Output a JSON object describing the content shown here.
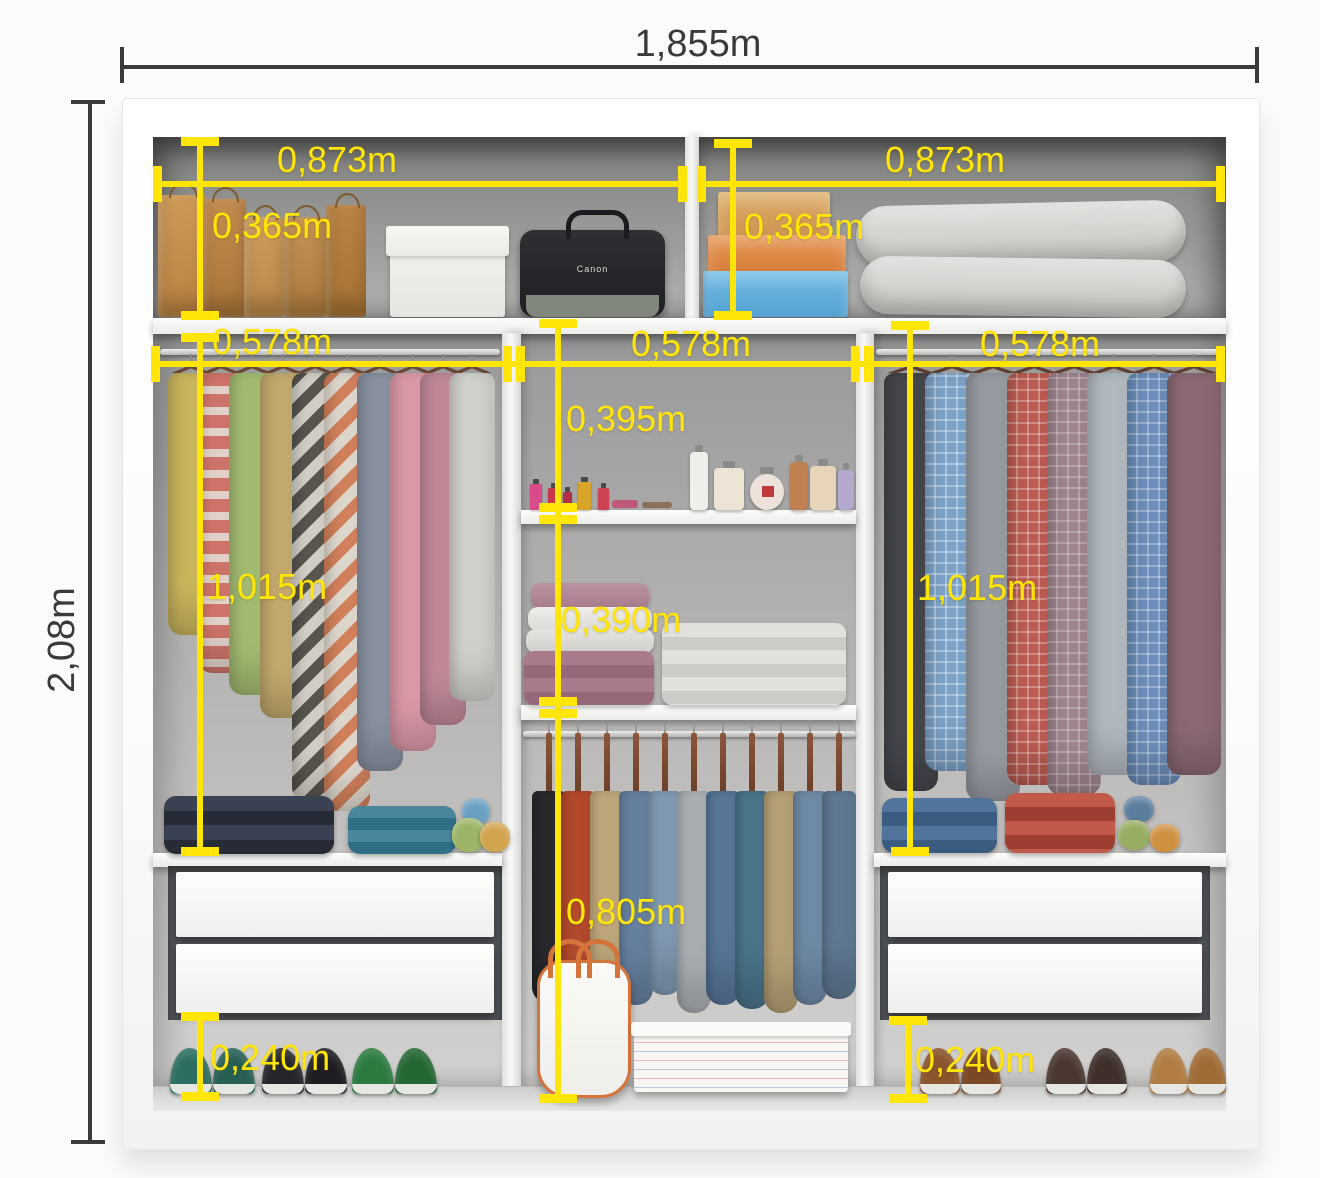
{
  "dimensions": {
    "overall_width": "1,855m",
    "overall_height": "2,08m",
    "top_shelf_left_width": "0,873m",
    "top_shelf_right_width": "0,873m",
    "top_shelf_left_height": "0,365m",
    "top_shelf_right_height": "0,365m",
    "left_column_width": "0,578m",
    "middle_column_width": "0,578m",
    "right_column_width": "0,578m",
    "middle_upper_section_height": "0,395m",
    "middle_towel_section_height": "0,390m",
    "left_hanging_height": "1,015m",
    "right_hanging_height": "1,015m",
    "middle_hanging_height": "0,805m",
    "left_shoe_area_height": "0,240m",
    "right_shoe_area_height": "0,240m"
  },
  "items": {
    "camera_bag_brand": "Canon"
  },
  "colors": {
    "dimension_yellow": "#ffe608",
    "dimension_black": "#3a3a3a",
    "wardrobe_white": "#ffffff",
    "interior_gray": "#b2b2b0"
  },
  "racks": {
    "left_clothes": {
      "style": "hanger",
      "top": 352,
      "w": 46,
      "hanger_color": "#6a4733",
      "items": [
        {
          "x": 168,
          "len": 262,
          "c": "#cdb85e",
          "p": "solid"
        },
        {
          "x": 198,
          "len": 300,
          "c": "#d2766c",
          "c2": "#e6d6ce",
          "p": "stripes"
        },
        {
          "x": 229,
          "len": 322,
          "c": "#a5be74",
          "p": "solid"
        },
        {
          "x": 260,
          "len": 345,
          "c": "#c6ac70",
          "p": "solid"
        },
        {
          "x": 292,
          "len": 428,
          "c": "#5a5650",
          "c2": "#d6d2ca",
          "p": "chevron"
        },
        {
          "x": 324,
          "len": 438,
          "c": "#d5835d",
          "c2": "#e2dbd0",
          "p": "chevron"
        },
        {
          "x": 357,
          "len": 398,
          "c": "#8b93a4",
          "p": "solid"
        },
        {
          "x": 390,
          "len": 378,
          "c": "#df9cab",
          "p": "solid"
        },
        {
          "x": 420,
          "len": 352,
          "c": "#c48b9b",
          "p": "solid"
        },
        {
          "x": 449,
          "len": 328,
          "c": "#d5d4d0",
          "p": "solid"
        }
      ]
    },
    "right_shirts": {
      "style": "hanger",
      "top": 352,
      "w": 54,
      "hanger_color": "#5f4030",
      "items": [
        {
          "x": 884,
          "len": 418,
          "c": "#45474d",
          "p": "solid"
        },
        {
          "x": 925,
          "len": 398,
          "c": "#7da4cb",
          "c2": "#ffffff59",
          "p": "check"
        },
        {
          "x": 966,
          "len": 428,
          "c": "#989ca3",
          "p": "solid"
        },
        {
          "x": 1007,
          "len": 412,
          "c": "#bd5c52",
          "c2": "#ffffff4d",
          "p": "check"
        },
        {
          "x": 1047,
          "len": 422,
          "c": "#9f8590",
          "c2": "#ffffff40",
          "p": "check"
        },
        {
          "x": 1087,
          "len": 402,
          "c": "#b3bac2",
          "p": "solid"
        },
        {
          "x": 1127,
          "len": 412,
          "c": "#6d8ebc",
          "c2": "#ffffff4d",
          "p": "check"
        },
        {
          "x": 1167,
          "len": 402,
          "c": "#8d6b74",
          "p": "solid"
        }
      ]
    },
    "middle_pants": {
      "style": "clip",
      "top": 731,
      "w": 34,
      "hanger_color": "#7a4a2e",
      "items": [
        {
          "x": 532,
          "len": 212,
          "c": "#2c2c30"
        },
        {
          "x": 561,
          "len": 218,
          "c": "#bf4e30"
        },
        {
          "x": 590,
          "len": 208,
          "c": "#ccb384"
        },
        {
          "x": 619,
          "len": 214,
          "c": "#6d89ab"
        },
        {
          "x": 648,
          "len": 204,
          "c": "#8aa4be"
        },
        {
          "x": 677,
          "len": 222,
          "c": "#b6bbc0"
        },
        {
          "x": 706,
          "len": 214,
          "c": "#5e7ea2"
        },
        {
          "x": 735,
          "len": 218,
          "c": "#4e7c93"
        },
        {
          "x": 764,
          "len": 222,
          "c": "#c2ac7d"
        },
        {
          "x": 793,
          "len": 214,
          "c": "#7794b2"
        },
        {
          "x": 822,
          "len": 208,
          "c": "#67819d"
        }
      ]
    }
  }
}
